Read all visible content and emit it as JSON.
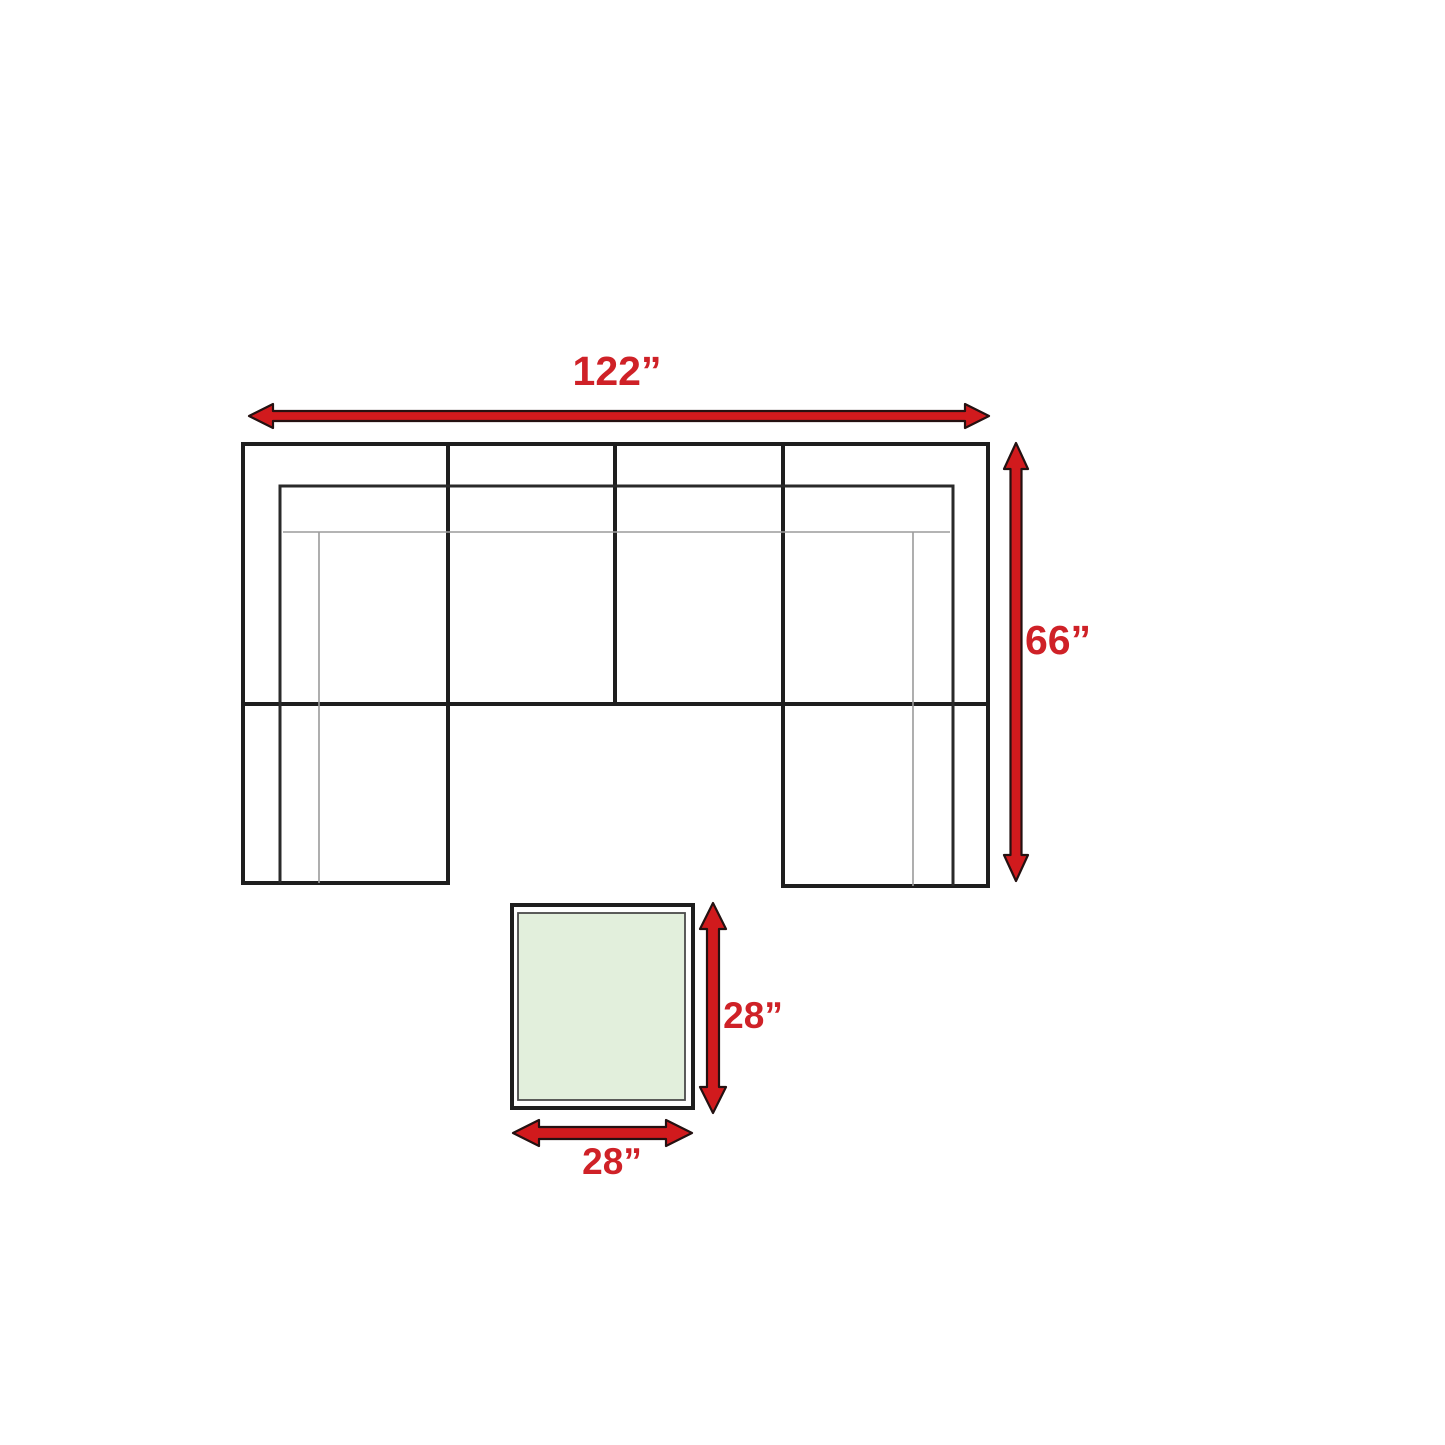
{
  "diagram": {
    "sofa": {
      "width_label": "122”",
      "depth_label": "66”"
    },
    "ottoman": {
      "depth_label": "28”",
      "width_label": "28”"
    }
  },
  "colors": {
    "background": "#ffffff",
    "arrow_fill": "#d11a1d",
    "arrow_outline": "#241111",
    "dimension_text": "#cf2127",
    "sofa_outline": "#1e1e1e",
    "seam_gray": "#9b9b9b",
    "ottoman_fill": "#e2efdc"
  }
}
